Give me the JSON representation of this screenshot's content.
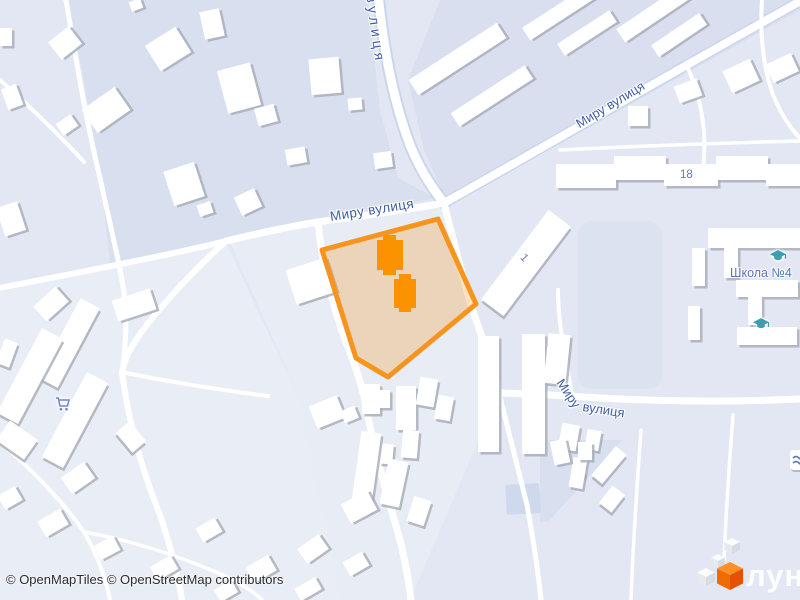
{
  "map": {
    "street_labels": {
      "miru_main": "Миру вулиця",
      "miru_diagonal": "Миру вулиця",
      "miru_lower_part1": "Миру",
      "miru_lower_part2": "вулиця",
      "top_vertical": "вулиця"
    },
    "house_numbers": {
      "building_18": "18",
      "building_1": "1"
    },
    "pois": {
      "school": {
        "label": "Школа №4",
        "icon": "graduation-cap"
      },
      "school_secondary": {
        "icon": "graduation-cap"
      },
      "shop": {
        "icon": "shopping-cart"
      }
    },
    "selection": {
      "border_color": "#F7941D",
      "fill_color": "#F7941D",
      "fill_opacity": 0.27,
      "building_color": "#FB9200"
    },
    "colors": {
      "background": "#E2E7F3",
      "residential_block": "#D8DFEE",
      "residential_block_alt": "#DADFF0",
      "field_light": "#E9EDF6",
      "field_light_alt": "#E8ECF5",
      "parcel": "#DCE3F0",
      "pond": "#CFD9ED",
      "road": "#FFFFFF",
      "road_casing": "#CBD5EB",
      "building": "#FFFFFF",
      "building_shadow": "#A6ABB7",
      "street_label": "#3F5FA3",
      "house_number_label": "#6877AD",
      "poi_label": "#5B74BD",
      "school_icon": "#3F9DB2",
      "cart_icon": "#7286C5",
      "logo_cube": "#F96A00"
    }
  },
  "attribution": {
    "text": "© OpenMapTiles © OpenStreetMap contributors"
  },
  "logo": {
    "wordmark": "лун"
  }
}
